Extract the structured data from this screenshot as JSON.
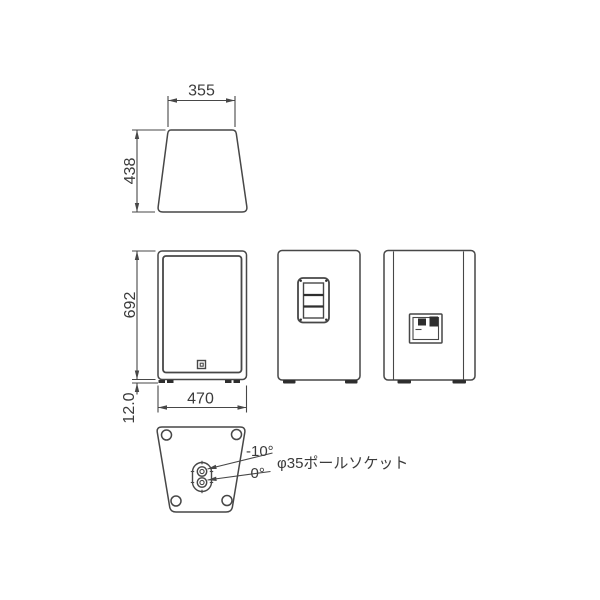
{
  "colors": {
    "line": "#474747",
    "text": "#3b3b3b",
    "background": "#ffffff",
    "dark_fill": "#2e2e2e"
  },
  "dimensions": {
    "top_view": {
      "width": "355",
      "depth": "438"
    },
    "front_view": {
      "height": "692",
      "foot_height": "12.0",
      "width": "470"
    }
  },
  "pole_socket": {
    "tilt_angle": "-10°",
    "zero_angle": "0°",
    "label": "φ35ポールソケット"
  }
}
